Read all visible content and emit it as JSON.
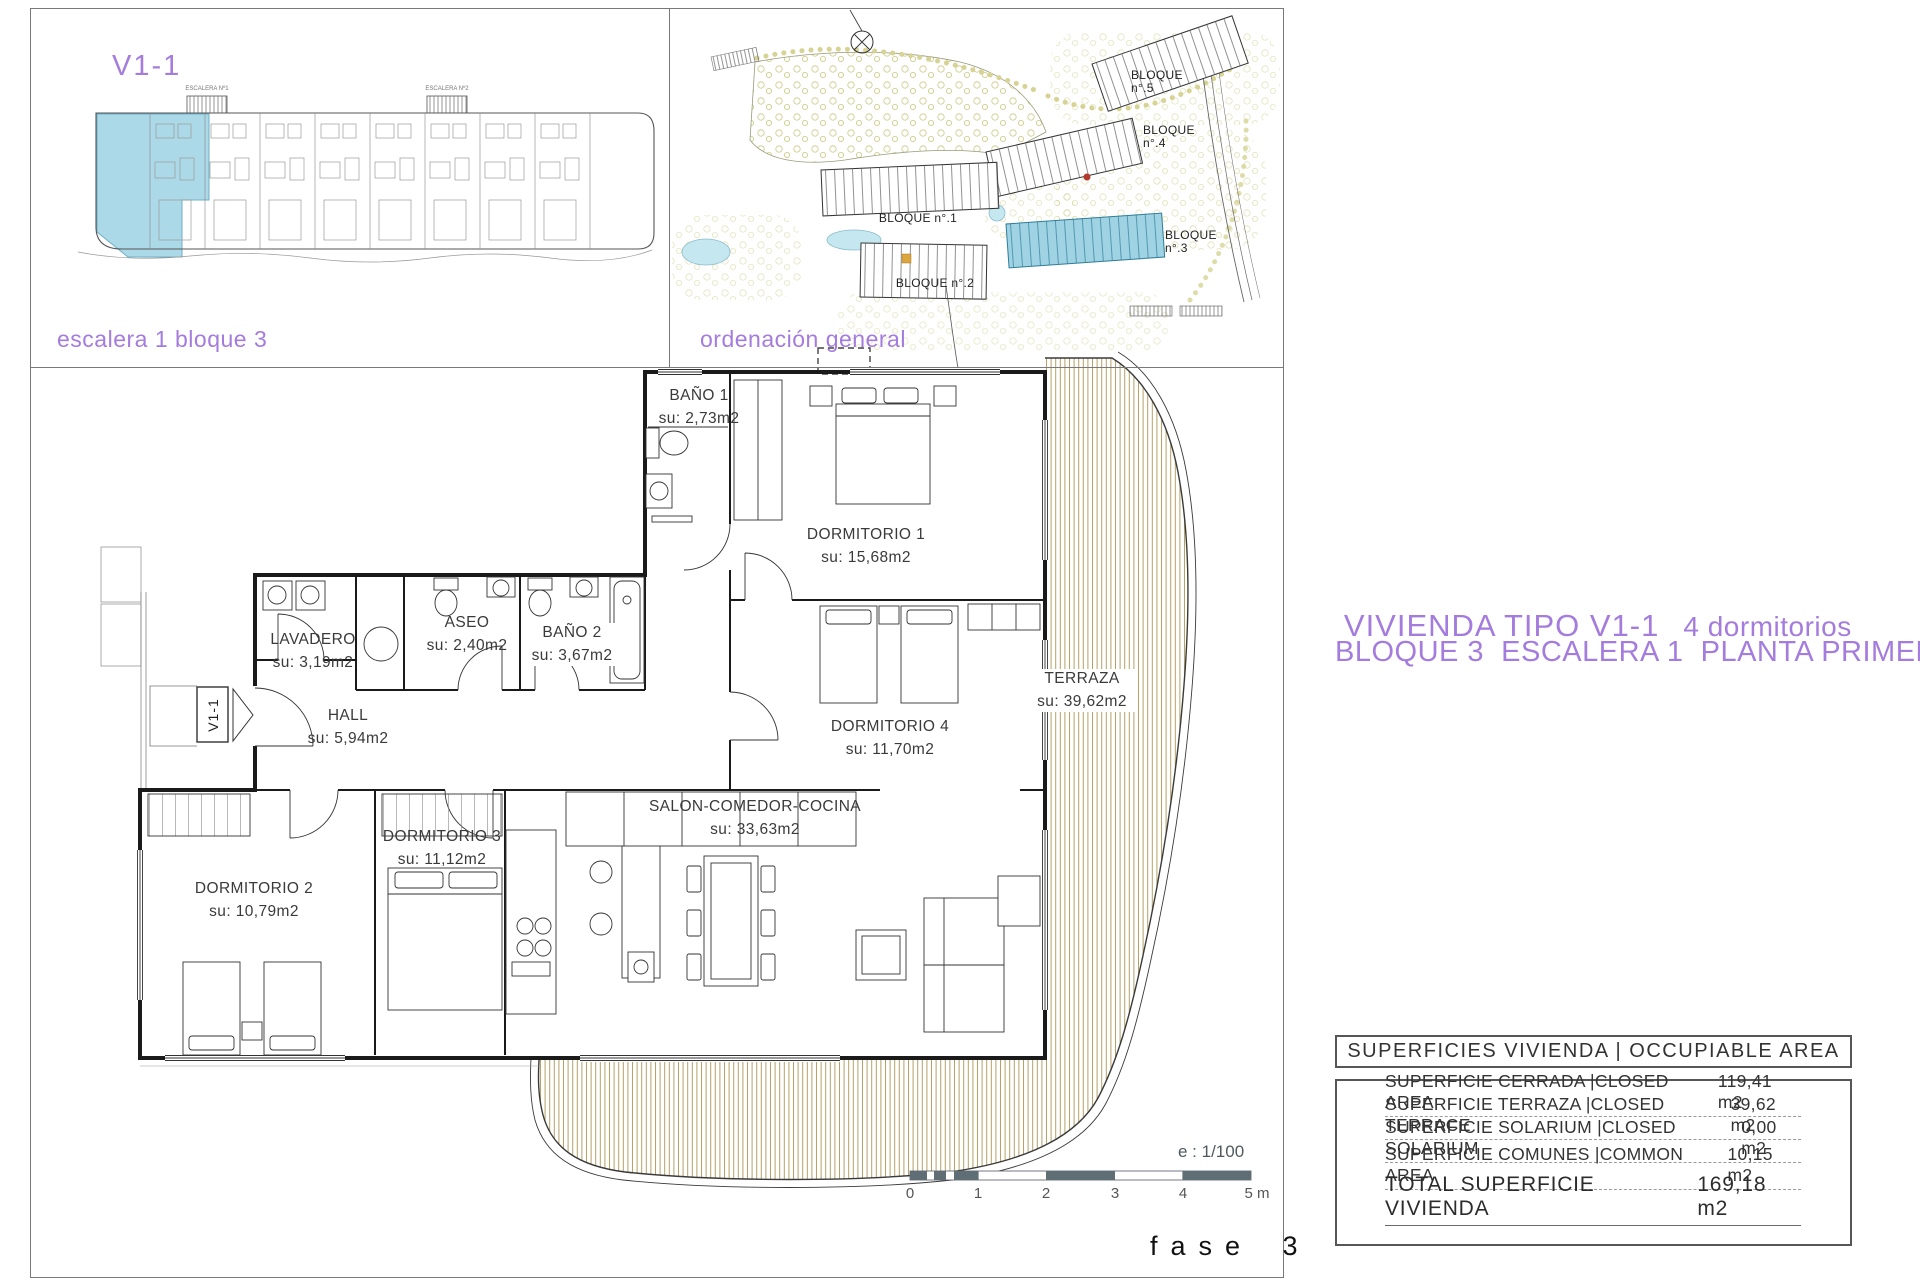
{
  "panel_escalera": {
    "unit_code": "V1-1",
    "caption": "escalera 1 bloque 3",
    "stair_labels": [
      "ESCALERA Nº1",
      "ESCALERA Nº2"
    ]
  },
  "panel_ordenacion": {
    "caption": "ordenación general",
    "block_labels": [
      "BLOQUE n°.1",
      "BLOQUE n°.2",
      "BLOQUE n°.3",
      "BLOQUE n°.4",
      "BLOQUE n°.5"
    ]
  },
  "plan_title": {
    "line1": "VIVIENDA TIPO V1-1",
    "line1_suffix": "4 dormitorios",
    "line2": "BLOQUE 3  ESCALERA 1  PLANTA PRIMERA"
  },
  "entry_tag": "V1-1",
  "rooms": [
    {
      "name": "BAÑO 1",
      "area": "su: 2,73m2"
    },
    {
      "name": "DORMITORIO 1",
      "area": "su: 15,68m2"
    },
    {
      "name": "LAVADERO",
      "area": "su: 3,19m2"
    },
    {
      "name": "ASEO",
      "area": "su: 2,40m2"
    },
    {
      "name": "BAÑO 2",
      "area": "su: 3,67m2"
    },
    {
      "name": "HALL",
      "area": "su: 5,94m2"
    },
    {
      "name": "DORMITORIO 4",
      "area": "su: 11,70m2"
    },
    {
      "name": "TERRAZA",
      "area": "su: 39,62m2"
    },
    {
      "name": "DORMITORIO 2",
      "area": "su: 10,79m2"
    },
    {
      "name": "DORMITORIO 3",
      "area": "su: 11,12m2"
    },
    {
      "name": "SALON-COMEDOR-COCINA",
      "area": "su: 33,63m2"
    }
  ],
  "scale": {
    "label": "e : 1/100",
    "ticks": [
      "0",
      "1",
      "2",
      "3",
      "4",
      "5 m"
    ]
  },
  "phase_label": "fase 3",
  "surface_table": {
    "header": "SUPERFICIES VIVIENDA | OCCUPIABLE AREA",
    "rows": [
      {
        "label": "SUPERFICIE CERRADA |CLOSED AREA",
        "value": "119,41 m2"
      },
      {
        "label": "SUPERFICIE TERRAZA |CLOSED TERRACE",
        "value": "39,62 m2"
      },
      {
        "label": "SUPERFICIE SOLARIUM |CLOSED SOLARIUM",
        "value": "0,00 m2"
      },
      {
        "label": "SUPERFICIE COMUNES |COMMON AREA",
        "value": "10,15 m2"
      }
    ],
    "total": {
      "label": "TOTAL SUPERFICIE VIVIENDA",
      "value": "169,18 m2"
    }
  },
  "colors": {
    "accent_purple": "#a47cdd",
    "highlight_blue": "#a3d5e5",
    "terrace_hatch": "#b39f63",
    "scalebar_gray": "#5f6e74"
  }
}
